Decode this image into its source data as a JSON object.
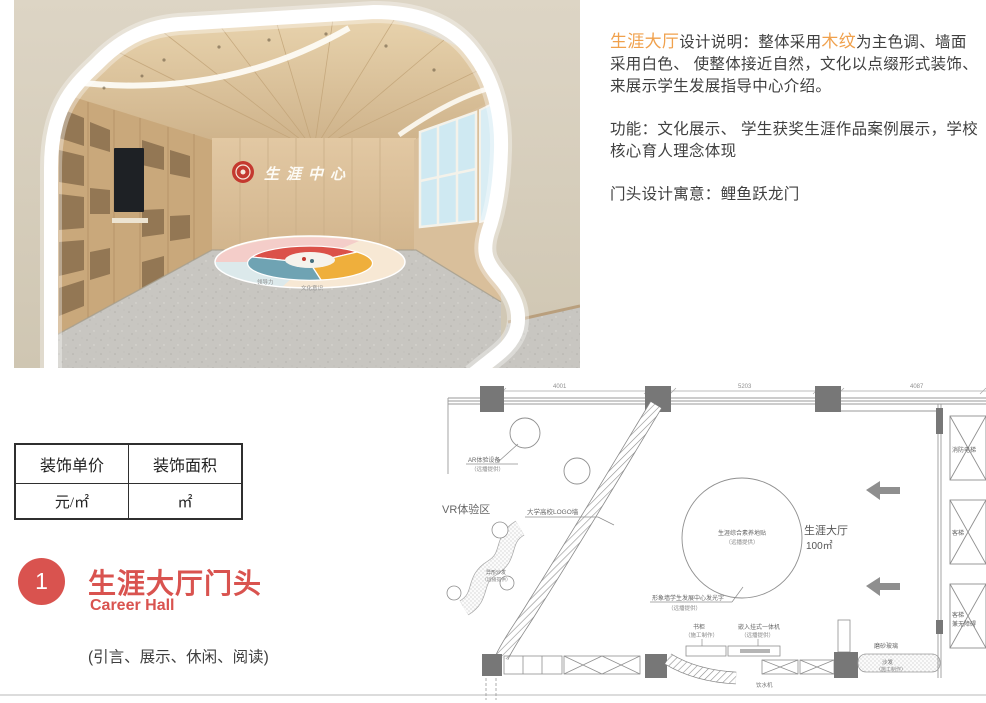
{
  "description": {
    "p1_highlight1": "生涯大厅",
    "p1_text1": "设计说明：整体采用",
    "p1_highlight2": "木纹",
    "p1_text2": "为主色调、墙面采用白色、 使整体接近自然，文化以点缀形式装饰、 来展示学生发展指导中心介绍。",
    "p2": "功能：文化展示、 学生获奖生涯作品案例展示，学校核心育人理念体现",
    "p3": "门头设计寓意：鲤鱼跃龙门",
    "highlight_color": "#F0A14D",
    "text_color": "#404040"
  },
  "pricing_table": {
    "headers": [
      "装饰单价",
      "装饰面积"
    ],
    "row": [
      "元/㎡",
      "㎡"
    ]
  },
  "section": {
    "number": "1",
    "title": "生涯大厅门头",
    "subtitle": "Career Hall",
    "note": "(引言、展示、休闲、阅读)",
    "accent_color": "#D9534F"
  },
  "render": {
    "signage": "生涯中心",
    "floor_graphic_label_1": "领导力",
    "floor_graphic_label_2": "文化意识",
    "colors": {
      "wall_beige": "#D8CFBE",
      "wood": "#DCC3A0",
      "floor_gray": "#C8C6C1",
      "logo_red": "#C4392F",
      "pie_red": "#DB5149",
      "pie_teal": "#6FA3B3",
      "pie_yellow": "#EFAF3C",
      "pie_pink": "#F4CDC9"
    }
  },
  "floor_plan": {
    "dimensions": [
      "4001",
      "5203",
      "4087"
    ],
    "area_label": "生涯大厅",
    "area_value": "100㎡",
    "labels": {
      "ar_device": "AR体验设备",
      "ar_device_note": "（远播提供）",
      "vr_zone": "VR体验区",
      "logo_wall": "大学高校LOGO墙",
      "floor_sticker": "生涯综合素养地贴",
      "floor_sticker_note": "（远播提供）",
      "shaped_sofa": "异形沙发",
      "shaped_sofa_note": "（远播提供）",
      "feature_wall": "形象墙学生发展中心发光字",
      "feature_wall_note": "（远播提供）",
      "bookcase": "书柜",
      "bookcase_note": "（施工制作）",
      "machine": "嵌入挂式一体机",
      "machine_note": "（远播提供）",
      "frosted_glass": "磨砂玻璃",
      "sofa": "沙发",
      "sofa_note": "（施工制作）",
      "water_machine": "饮水机",
      "elevator_fire": "消防电梯",
      "elevator_passenger": "客梯",
      "elevator_accessible_1": "客梯",
      "elevator_accessible_2": "兼无障碍"
    }
  }
}
